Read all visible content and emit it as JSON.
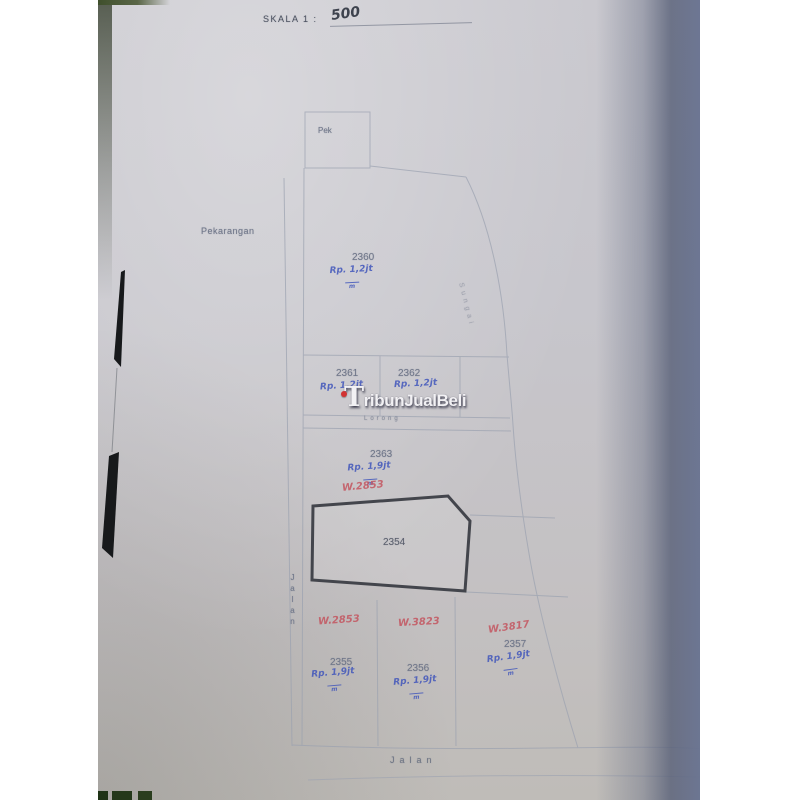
{
  "scale": {
    "label": "SKALA 1 :",
    "value": "500"
  },
  "watermark": {
    "text": "TribunJualBeli"
  },
  "area_labels": {
    "pek": "Pek",
    "pekarangan": "Pekarangan",
    "lorong": "Lorong",
    "sungai": "Sungai",
    "jalan_left": "Jalan",
    "jalan_bottom": "Jalan"
  },
  "plots": {
    "p2354": {
      "id": "2354"
    },
    "p2360": {
      "id": "2360",
      "price": "Rp. 1,2jt",
      "per": "m"
    },
    "p2361": {
      "id": "2361",
      "price": "Rp. 1,2jt"
    },
    "p2362": {
      "id": "2362",
      "price": "Rp. 1,2jt"
    },
    "p2363": {
      "id": "2363",
      "price": "Rp. 1,9jt",
      "per": "m",
      "code": "W.2853"
    },
    "p2355": {
      "id": "2355",
      "price": "Rp. 1,9jt",
      "per": "m",
      "code": "W.2853"
    },
    "p2356": {
      "id": "2356",
      "price": "Rp. 1,9jt",
      "per": "m",
      "code": "W.3823"
    },
    "p2357": {
      "id": "2357",
      "price": "Rp. 1,9jt",
      "per": "m",
      "code": "W.3817"
    }
  },
  "colors": {
    "paper": "#c7c6cc",
    "map_line": "#9ba1b0",
    "printed_text": "#6f7689",
    "bold_plot_border": "#43454c",
    "hand_blue": "#4156bb",
    "hand_red": "#c4515c",
    "hand_dark": "#2e3340",
    "watermark_red_dot": "#d23333",
    "page_edge_band": "#5e667e",
    "table_edge_green": "#3f4f2c",
    "ink_mark_black": "#17191b"
  }
}
